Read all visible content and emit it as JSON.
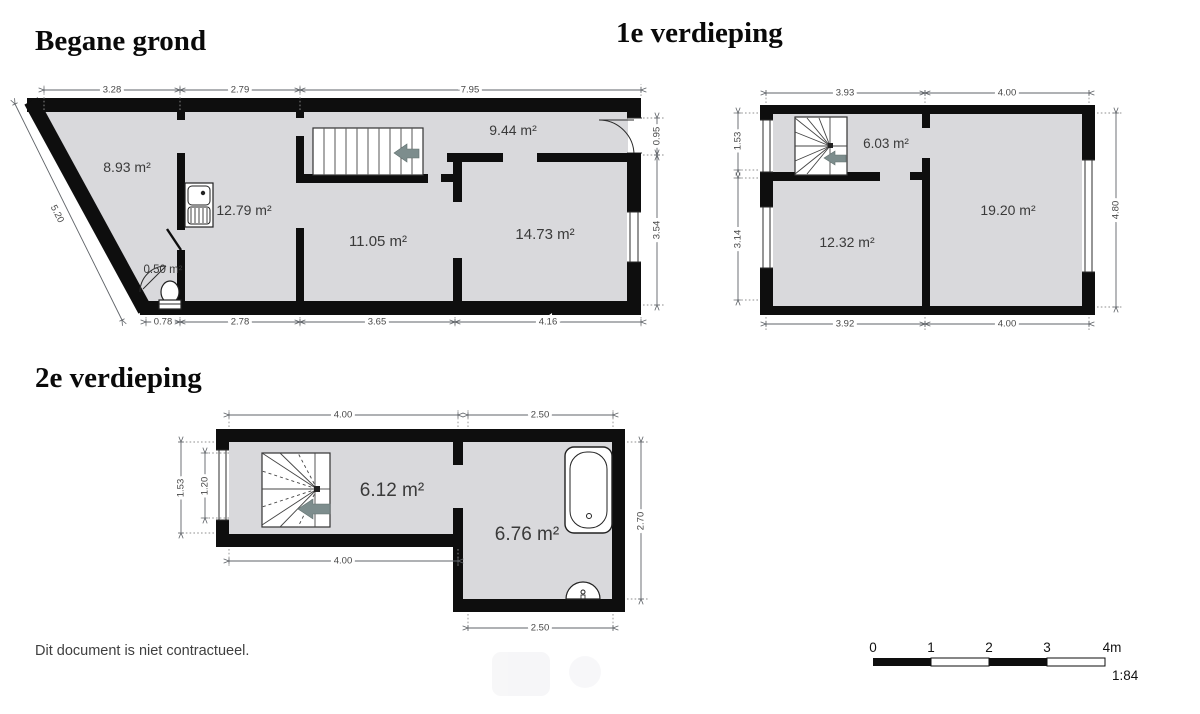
{
  "page": {
    "disclaimer": "Dit document is niet contractueel."
  },
  "floors": {
    "ground": {
      "title": "Begane grond",
      "rooms": {
        "r1": "8.93 m²",
        "r2": "12.79 m²",
        "r3": "11.05 m²",
        "r4": "9.44 m²",
        "r5": "14.73 m²",
        "wc": "0.50 m²"
      },
      "dims": {
        "top1": "3.28",
        "top2": "2.79",
        "top3": "7.95",
        "bottom1": "0.78",
        "bottom2": "2.78",
        "bottom3": "3.65",
        "bottom4": "4.16",
        "right1": "0.95",
        "right2": "3.54",
        "slant": "5.20"
      }
    },
    "first": {
      "title": "1e verdieping",
      "rooms": {
        "hall": "6.03 m²",
        "r1": "12.32 m²",
        "r2": "19.20 m²"
      },
      "dims": {
        "top1": "3.93",
        "top2": "4.00",
        "bottom1": "3.92",
        "bottom2": "4.00",
        "left1": "1.53",
        "left2": "3.14",
        "right1": "4.80"
      }
    },
    "second": {
      "title": "2e verdieping",
      "rooms": {
        "r1": "6.12 m²",
        "r2": "6.76 m²"
      },
      "dims": {
        "top1": "4.00",
        "top2": "2.50",
        "left1": "1.53",
        "left2": "1.20",
        "right1": "2.70",
        "bottom1": "4.00",
        "bottom2": "2.50"
      }
    }
  },
  "scalebar": {
    "t0": "0",
    "t1": "1",
    "t2": "2",
    "t3": "3",
    "t4": "4m",
    "ratio": "1:84"
  }
}
